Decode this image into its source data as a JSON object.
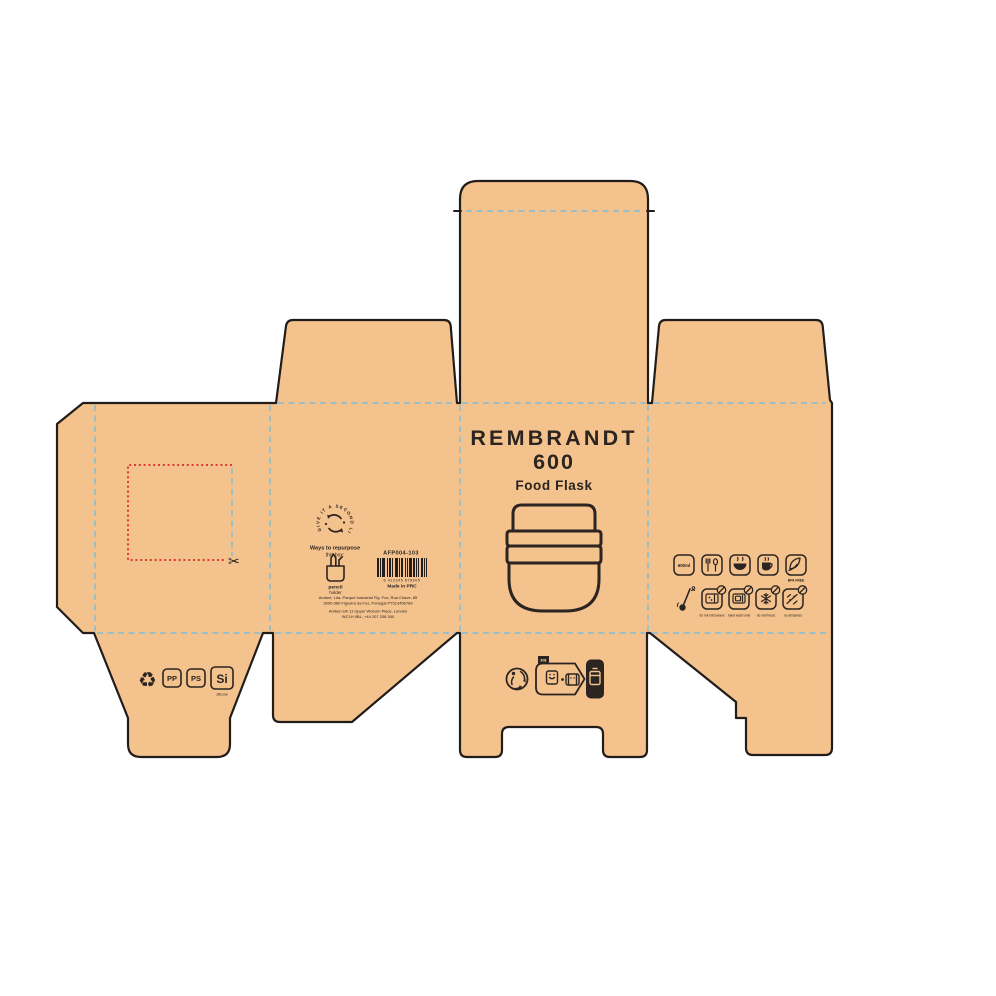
{
  "colors": {
    "board": "#F4C28D",
    "cut_line": "#221D1A",
    "fold_line": "#8FBFCF",
    "perforation": "#E0392E",
    "ink": "#2B2420",
    "background": "#FFFFFF"
  },
  "front_panel": {
    "title": "REMBRANDT",
    "model": "600",
    "subtitle": "Food Flask"
  },
  "back_panel": {
    "ring_text": "GIVE IT A SECOND LIFE",
    "repurpose_heading": "Ways to repurpose",
    "repurpose_sub": "this box:",
    "idea_word1": "pencil",
    "idea_word2": "holder",
    "sku": "AFP004-103",
    "barcode_digits": "8 412345 678905",
    "made_in": "Made in PRC",
    "address_line1": "Amberi, Lda. Parque Industrial Fig. Foz, Rua Chave, 85",
    "address_line2": "3090-380 Figueira da Foz, Portugal PT513456789",
    "address_line3": "Amberi UK 11 Upper Woburn Place, London",
    "address_line4": "WC1H 0BL, +44 207 208 300"
  },
  "right_panel": {
    "capacity": "600ml",
    "caption_bpa": "BPA FREE",
    "caption_microwave": "do not microwave",
    "caption_dishwasher": "hand wash only",
    "caption_freezer": "do not freeze",
    "caption_abrasives": "no abrasives"
  },
  "bottom_left_flap": {
    "material1": "PP",
    "material2": "PS",
    "material3": "Si",
    "material3_caption": "silicone"
  },
  "bottom_front_flap": {
    "sorting_tab": "FR"
  }
}
